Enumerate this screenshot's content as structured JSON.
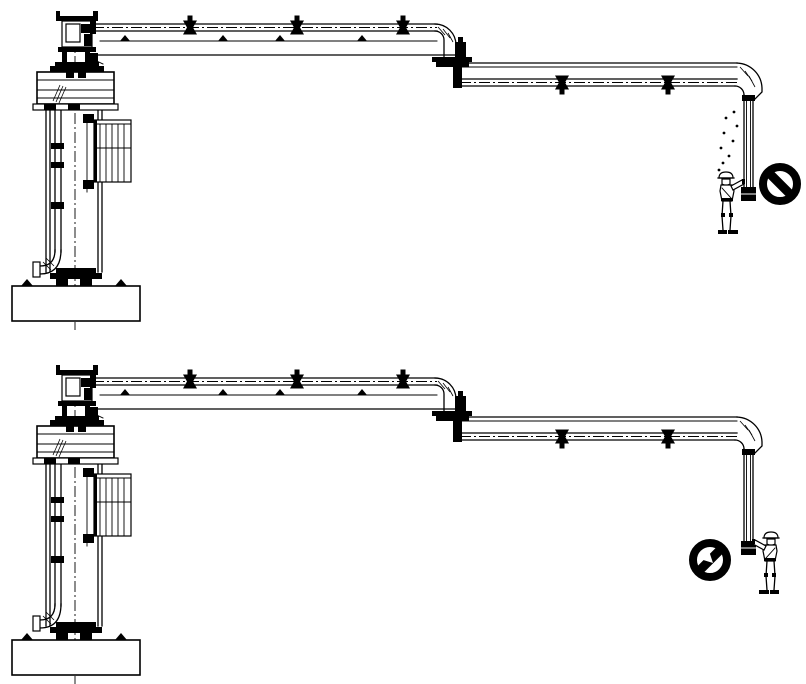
{
  "canvas": {
    "width": 806,
    "height": 684,
    "background": "#ffffff",
    "line_color": "#000000"
  },
  "diagram": {
    "type": "technical-line-drawing",
    "subject": "articulated loading arm with support column, drop pipe, operator figure and prohibition symbol",
    "views": [
      {
        "id": "upper-view",
        "description": "Loading arm with outlet drop pipe hanging high; liquid drips fall from the coupler; operator stands left of the drop pipe reaching up to it; black prohibition circle-slash symbol to the right",
        "operator": {
          "position": "left-of-drop-pipe",
          "facing": "right",
          "arm": "raised-touching-coupler"
        },
        "sign": {
          "kind": "prohibition-icon",
          "slash": "top-left-to-bottom-right",
          "inner_mark": "none"
        },
        "drips": {
          "visible": true,
          "points": [
            [
              734,
              112
            ],
            [
              726,
              118
            ],
            [
              737,
              126
            ],
            [
              724,
              133
            ],
            [
              733,
              141
            ],
            [
              721,
              148
            ],
            [
              729,
              156
            ],
            [
              723,
              163
            ],
            [
              719,
              170
            ]
          ]
        }
      },
      {
        "id": "lower-view",
        "description": "Loading arm with outlet drop pipe lowered; operator stands right of the drop pipe holding the coupler; black prohibition circle-slash symbol with white arrow mark to the left",
        "operator": {
          "position": "right-of-drop-pipe",
          "facing": "left",
          "arm": "extended-touching-coupler"
        },
        "sign": {
          "kind": "prohibition-icon",
          "slash": "bottom-left-to-top-right",
          "inner_mark": "white-arrow"
        },
        "drips": {
          "visible": false,
          "points": []
        }
      }
    ]
  }
}
